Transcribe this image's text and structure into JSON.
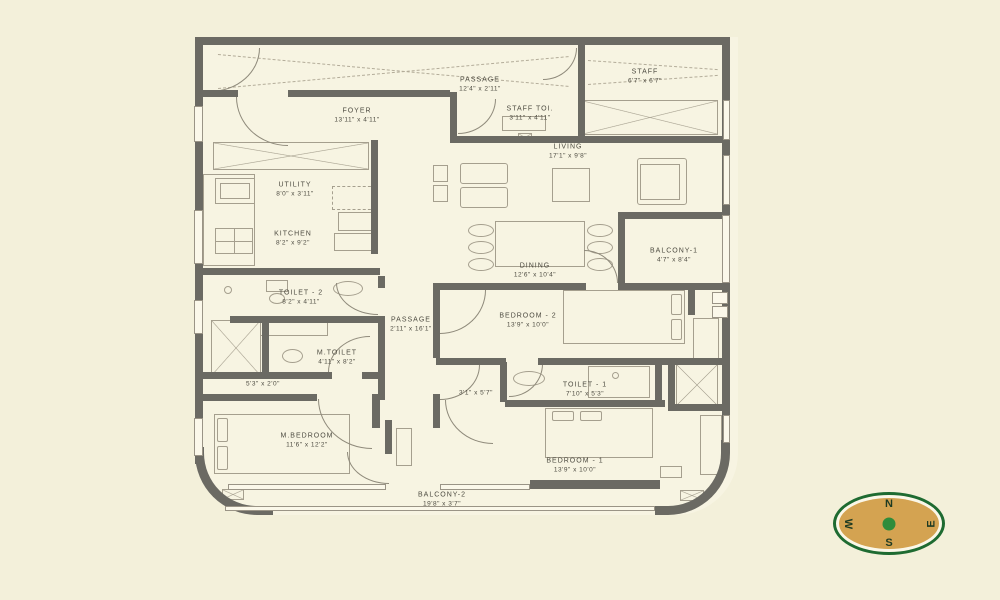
{
  "theme": {
    "page_bg": "#f3f0da",
    "floor": "#f7f4e2",
    "wall": "#6b6a63",
    "line": "#a59f8e",
    "line_dark": "#8f8a7b",
    "text": "#4d4b41",
    "compass_ring": "#1e6b31",
    "compass_fill": "#d4a351",
    "compass_dot": "#2f8c3b",
    "compass_text": "#1d3a22"
  },
  "plan": {
    "rooms": {
      "passage_top": {
        "name": "PASSAGE",
        "dims": "12'4\" x 2'11\""
      },
      "staff": {
        "name": "STAFF",
        "dims": "6'7\" x 6'7\""
      },
      "staff_toilet": {
        "name": "STAFF TOI.",
        "dims": "3'11\" x 4'11\""
      },
      "foyer": {
        "name": "FOYER",
        "dims": "13'11\" x 4'11\""
      },
      "living": {
        "name": "LIVING",
        "dims": "17'1\" x 9'8\""
      },
      "utility": {
        "name": "UTILITY",
        "dims": "8'0\" x 3'11\""
      },
      "kitchen": {
        "name": "KITCHEN",
        "dims": "8'2\" x 9'2\""
      },
      "dining": {
        "name": "DINING",
        "dims": "12'6\" x 10'4\""
      },
      "balcony1": {
        "name": "BALCONY-1",
        "dims": "4'7\" x 8'4\""
      },
      "toilet2": {
        "name": "TOILET - 2",
        "dims": "8'2\" x 4'11\""
      },
      "m_toilet": {
        "name": "M.TOILET",
        "dims": "4'11\" x 8'2\""
      },
      "passage_mid": {
        "name": "PASSAGE",
        "dims": "2'11\" x 16'1\""
      },
      "bedroom2": {
        "name": "BEDROOM - 2",
        "dims": "13'9\" x 10'0\""
      },
      "toilet1": {
        "name": "TOILET - 1",
        "dims": "7'10\" x 5'3\""
      },
      "m_bedroom": {
        "name": "M.BEDROOM",
        "dims": "11'6\" x 12'2\""
      },
      "bedroom1": {
        "name": "BEDROOM - 1",
        "dims": "13'9\" x 10'0\""
      },
      "balcony2": {
        "name": "BALCONY-2",
        "dims": "19'8\" x 3'7\""
      }
    },
    "dim_labels": {
      "dressing": "5'3\" x 2'0\"",
      "lobby": "3'1\" x 5'7\""
    }
  },
  "compass": {
    "north": "N",
    "south": "S",
    "east": "E",
    "west": "W"
  }
}
